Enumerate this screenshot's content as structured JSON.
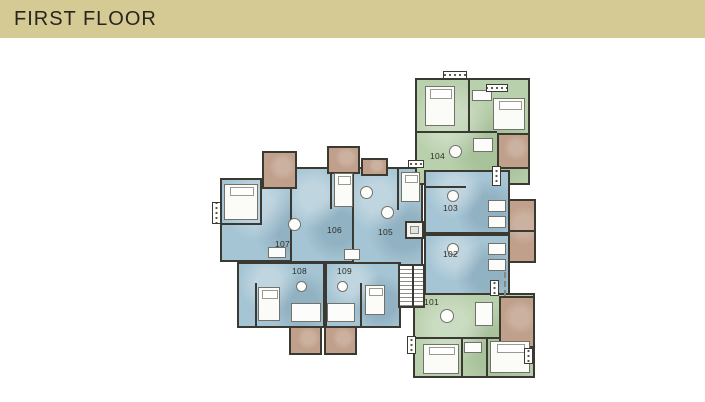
{
  "header": {
    "title": "FIRST FLOOR"
  },
  "plan": {
    "kind": "architectural floor plan",
    "units": [
      {
        "number": "101",
        "category": "green"
      },
      {
        "number": "102",
        "category": "blue"
      },
      {
        "number": "103",
        "category": "blue"
      },
      {
        "number": "104",
        "category": "green"
      },
      {
        "number": "105",
        "category": "blue"
      },
      {
        "number": "106",
        "category": "blue"
      },
      {
        "number": "107",
        "category": "blue"
      },
      {
        "number": "108",
        "category": "blue"
      },
      {
        "number": "109",
        "category": "blue"
      }
    ],
    "colors": {
      "header_bg": "#d5ca93",
      "header_text": "#26261f",
      "canvas": "#ffffff",
      "unit_green": "#b9d0ac",
      "unit_blue": "#a6c5d4",
      "balcony_brown": "#c0a08b",
      "wall": "#3a3a33"
    }
  }
}
